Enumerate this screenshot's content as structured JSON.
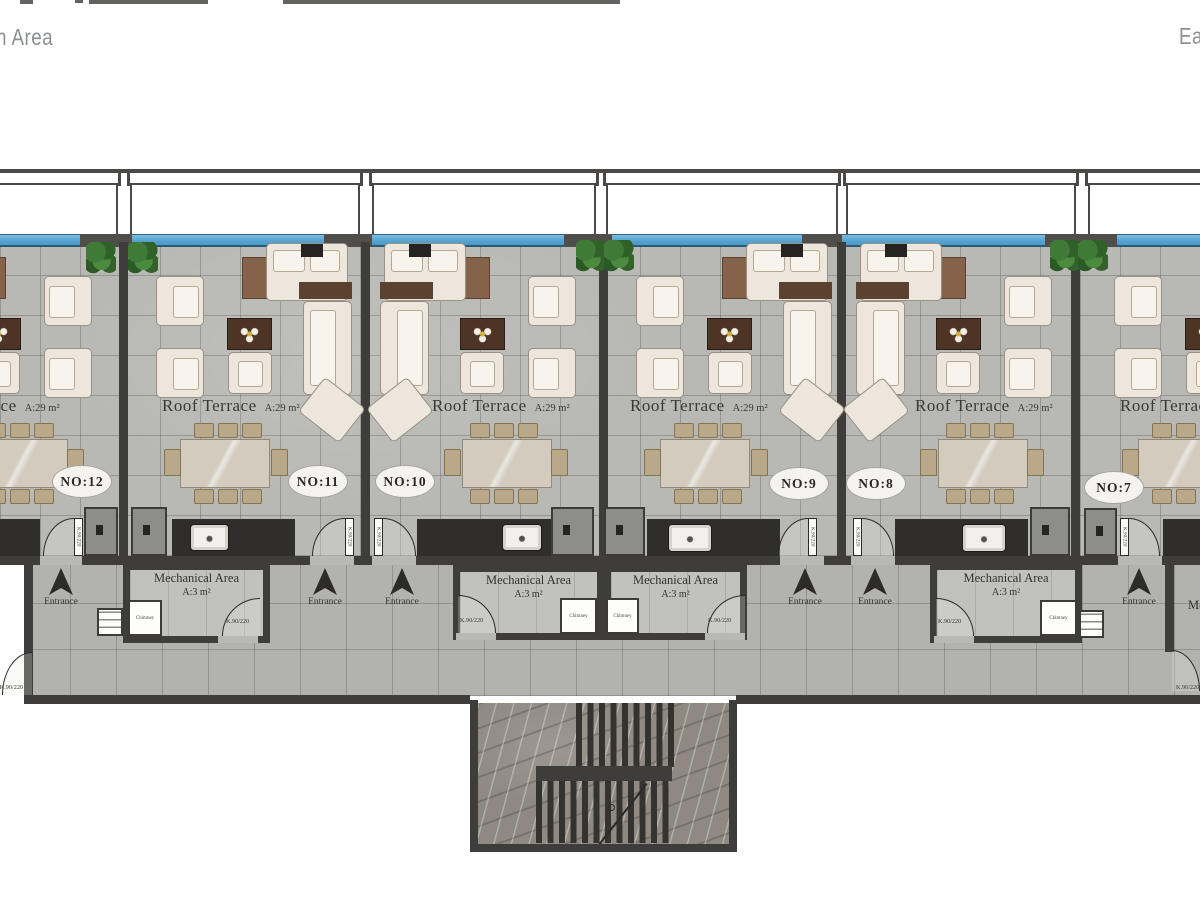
{
  "header": {
    "left_title": "n Area",
    "right_title": "Ea"
  },
  "plan": {
    "roof_terrace": {
      "label": "Roof Terrace",
      "area": "A:29 m²"
    },
    "units": [
      {
        "badge": "NO:12"
      },
      {
        "badge": "NO:11"
      },
      {
        "badge": "NO:10"
      },
      {
        "badge": "NO:9"
      },
      {
        "badge": "NO:8"
      },
      {
        "badge": "NO:7"
      }
    ],
    "entrance": {
      "label": "Entrance"
    },
    "mechanical_area": {
      "label": "Mechanical Area",
      "area": "A:3 m²"
    },
    "chimney": {
      "label": "Chimney"
    },
    "door_size": {
      "label": "K.90/220"
    }
  },
  "colors": {
    "railing_blue": "#58a5d2",
    "wall_dark": "#3e3d3b",
    "terrace_tile": "#b8b8b4",
    "corridor_tile": "#b2b2ae",
    "plant_green": "#3f7a36",
    "furniture_cream": "#ece6dc",
    "stair_marble": "#8f8982",
    "header_gray": "#8d9093"
  }
}
